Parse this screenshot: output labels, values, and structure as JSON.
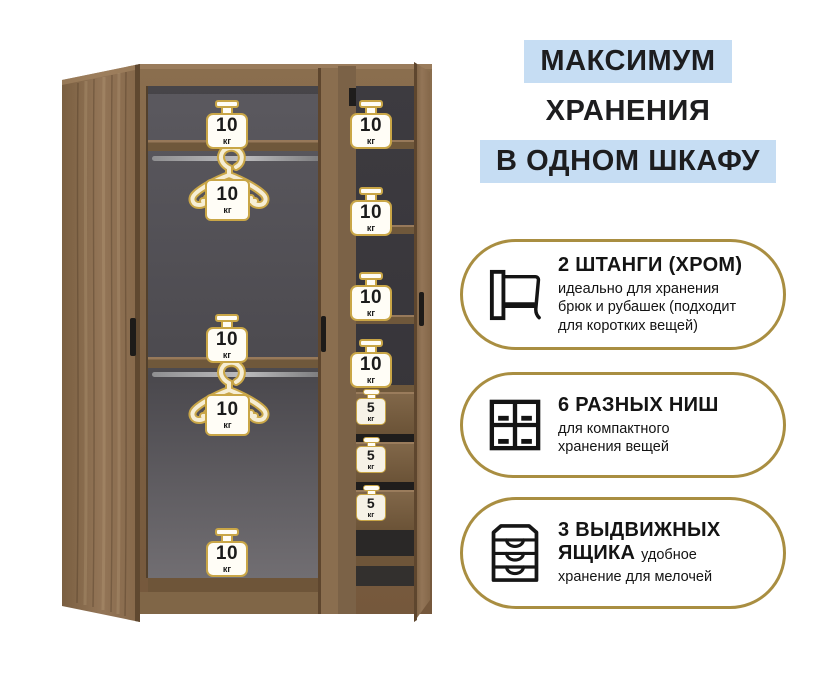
{
  "header": {
    "line1": "МАКСИМУМ",
    "line2": "ХРАНЕНИЯ",
    "line3": "В ОДНОМ ШКАФУ"
  },
  "features": [
    {
      "icon": "rod-icon",
      "title": "2 ШТАНГИ (ХРОМ)",
      "lines": [
        "идеально для хранения",
        "брюк и рубашек (подходит",
        "для коротких вещей)"
      ]
    },
    {
      "icon": "niches-icon",
      "title": "6 РАЗНЫХ НИШ",
      "lines": [
        "для компактного",
        "хранения вещей"
      ]
    },
    {
      "icon": "drawers-icon",
      "title_l1": "3 ВЫДВИЖНЫХ",
      "title_l2": "ЯЩИКА",
      "body_inline": "удобное",
      "body_l2": "хранение для мелочей"
    }
  ],
  "wardrobe": {
    "left_badges": [
      {
        "value": "10",
        "unit": "кг"
      },
      {
        "value": "10",
        "unit": "кг"
      },
      {
        "value": "10",
        "unit": "кг"
      },
      {
        "value": "10",
        "unit": "кг"
      },
      {
        "value": "10",
        "unit": "кг"
      }
    ],
    "right_badges": [
      {
        "value": "10",
        "unit": "кг"
      },
      {
        "value": "10",
        "unit": "кг"
      },
      {
        "value": "10",
        "unit": "кг"
      },
      {
        "value": "10",
        "unit": "кг"
      }
    ],
    "drawer_badges": [
      {
        "value": "5",
        "unit": "кг"
      },
      {
        "value": "5",
        "unit": "кг"
      },
      {
        "value": "5",
        "unit": "кг"
      }
    ]
  },
  "colors": {
    "accent_gold": "#a98e41",
    "badge_gold": "#c9a647",
    "highlight_blue": "#c6ddf3",
    "text_dark": "#1d1d1f",
    "wood": "#82684a",
    "interior_gray": "#4e4c51"
  }
}
